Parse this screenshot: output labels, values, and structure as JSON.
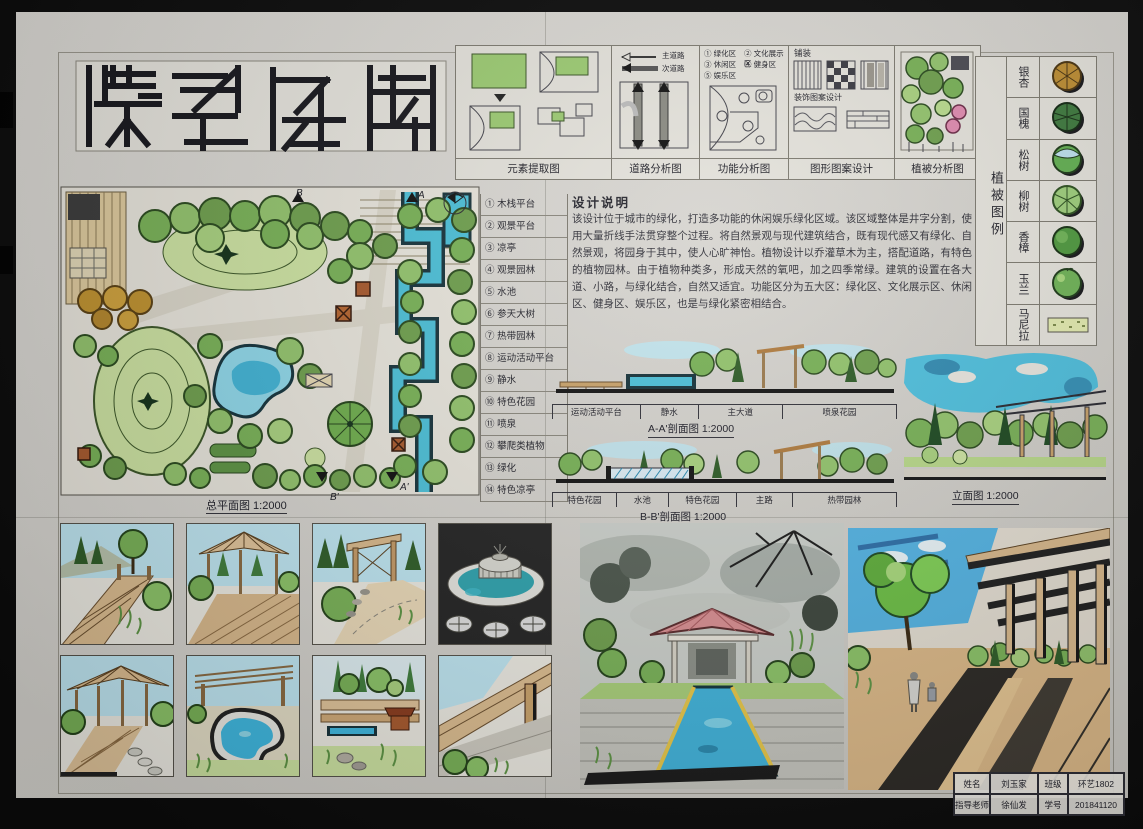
{
  "board": {
    "plan_caption": "总平面图 1:2000",
    "markers": {
      "a": "A",
      "a_prime": "A'",
      "b": "B",
      "b_prime": "B'"
    }
  },
  "analysis_strip": {
    "panels": [
      {
        "caption": "元素提取图"
      },
      {
        "caption": "道路分析图",
        "legend": [
          "主道路",
          "次道路"
        ]
      },
      {
        "caption": "功能分析图",
        "legend": [
          "① 绿化区",
          "② 文化展示区",
          "③ 休闲区",
          "④ 健身区",
          "⑤ 娱乐区"
        ]
      },
      {
        "caption": "图形图案设计",
        "labels": [
          "铺装",
          "装饰图案设计"
        ]
      },
      {
        "caption": "植被分析图"
      }
    ]
  },
  "plant_legend": {
    "header": "植被图例",
    "items": [
      {
        "name": "银杏",
        "color": "#bf8f33"
      },
      {
        "name": "国槐",
        "color": "#3e7a3e"
      },
      {
        "name": "松树",
        "color": "#63b152"
      },
      {
        "name": "柳树",
        "color": "#9fd07c"
      },
      {
        "name": "香樟",
        "color": "#4f9a3f"
      },
      {
        "name": "玉兰",
        "color": "#6fb457"
      },
      {
        "name": "马尼拉",
        "color": "#e4ecb0"
      }
    ]
  },
  "plan_legend": {
    "items": [
      "① 木栈平台",
      "② 观景平台",
      "③ 凉亭",
      "④ 观景园林",
      "⑤ 水池",
      "⑥ 参天大树",
      "⑦ 热带园林",
      "⑧ 运动活动平台",
      "⑨ 静水",
      "⑩ 特色花园",
      "⑪ 喷泉",
      "⑫ 攀爬类植物",
      "⑬ 绿化",
      "⑭ 特色凉亭"
    ]
  },
  "design_notes": {
    "title": "设计说明",
    "body": "该设计位于城市的绿化，打造多功能的休闲娱乐绿化区域。该区域整体是井字分割，使用大量折线手法贯穿整个过程。将自然景观与现代建筑结合，既有现代感又有绿化、自然景观，将园身于其中，使人心旷神怡。植物设计以乔灌草木为主，搭配道路，有特色的植物园林。由于植物种类多，形成天然的氧吧，加之四季常绿。建筑的设置在各大道、小路，与绿化结合，自然又适宜。功能区分为五大区：绿化区、文化展示区、休闲区、健身区、娱乐区，也是与绿化紧密相结合。"
  },
  "sections": {
    "aa": {
      "caption": "A-A'剖面图 1:2000",
      "segments": [
        "运动活动平台",
        "静水",
        "主大道",
        "喷泉花园"
      ]
    },
    "bb": {
      "caption": "B-B'剖面图 1:2000",
      "segments": [
        "特色花园",
        "水池",
        "特色花园",
        "主路",
        "热带园林"
      ]
    },
    "elevation": {
      "caption": "立面图 1:2000"
    }
  },
  "title_block": {
    "rows": [
      [
        "姓名",
        "刘玉家",
        "班级",
        "环艺1802"
      ],
      [
        "指导老师",
        "徐仙发",
        "学号",
        "201841120"
      ]
    ]
  },
  "colors": {
    "canopy_green": "#79b257",
    "light_green": "#a9d27f",
    "dark_green": "#2f5d28",
    "lawn": "#cde3a2",
    "water_cyan": "#4cc0d8",
    "sky_blue": "#54b4e4",
    "wood_tan": "#d9b98c",
    "pavilion_brown": "#a85a2e",
    "roof_pink": "#d98f92",
    "ginkgo_ochre": "#c0922f",
    "ink": "#1d1d26"
  }
}
